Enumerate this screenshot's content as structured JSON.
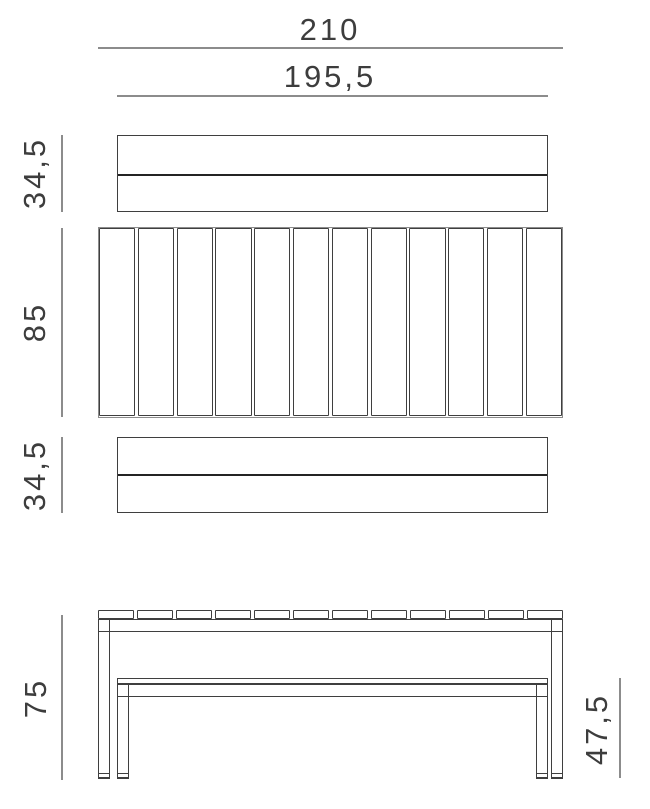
{
  "drawing": {
    "dimensions": {
      "table_length": "210",
      "bench_length": "195,5",
      "bench_top_depth": "34,5",
      "table_top_depth": "85",
      "bench_bottom_depth": "34,5",
      "table_height": "75",
      "bench_height": "47,5"
    },
    "table_top_slat_count": 12,
    "colors": {
      "outline": "#3f3f3f",
      "dimension_line": "#8c8c8c",
      "label_text": "#3d3d3d",
      "background": "#ffffff"
    }
  }
}
